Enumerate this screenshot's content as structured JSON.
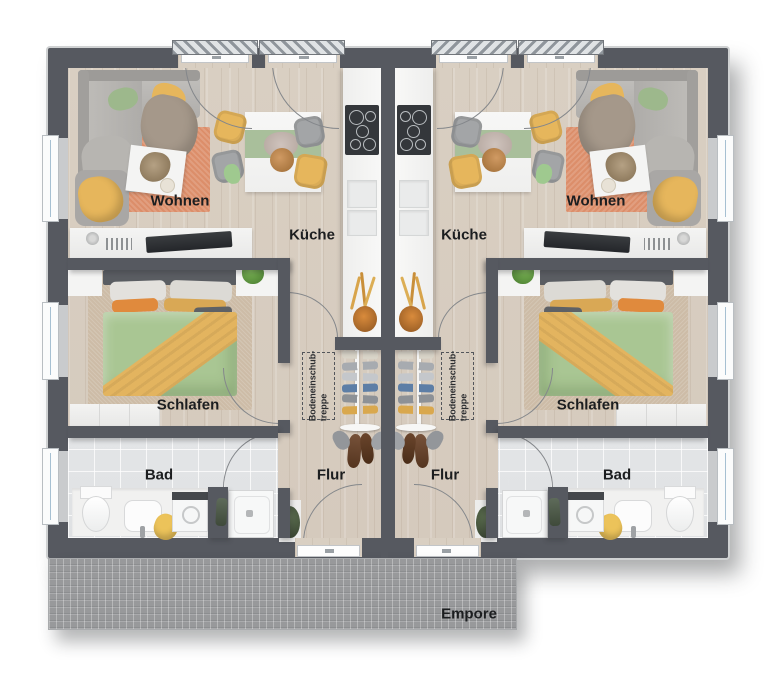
{
  "colors": {
    "wall": "#565960",
    "wall_edge": "#cfd1d2",
    "wood": "#d9cfc2",
    "tile": "#dfe1e3",
    "rug_living": "#dc8e6a",
    "rug_bed": "#cdbca7",
    "bed_green": "#a9c693",
    "accent_yellow": "#e6b65c",
    "chair_gray": "#a3a5a7",
    "runner_green": "#a9bf9b",
    "furniture_white": "#f4f4f3",
    "empore": "#98999b",
    "arc": "#84878b",
    "label_text": "#1c1e20"
  },
  "unit_left": {
    "living": "Wohnen",
    "kitchen": "Küche",
    "bedroom": "Schlafen",
    "bath": "Bad",
    "hall": "Flur",
    "attic_line1": "Bodeneinschub-",
    "attic_line2": "treppe"
  },
  "unit_right": {
    "living": "Wohnen",
    "kitchen": "Küche",
    "bedroom": "Schlafen",
    "bath": "Bad",
    "hall": "Flur",
    "attic_line1": "Bodeneinschub-",
    "attic_line2": "treppe"
  },
  "empore_label": "Empore"
}
